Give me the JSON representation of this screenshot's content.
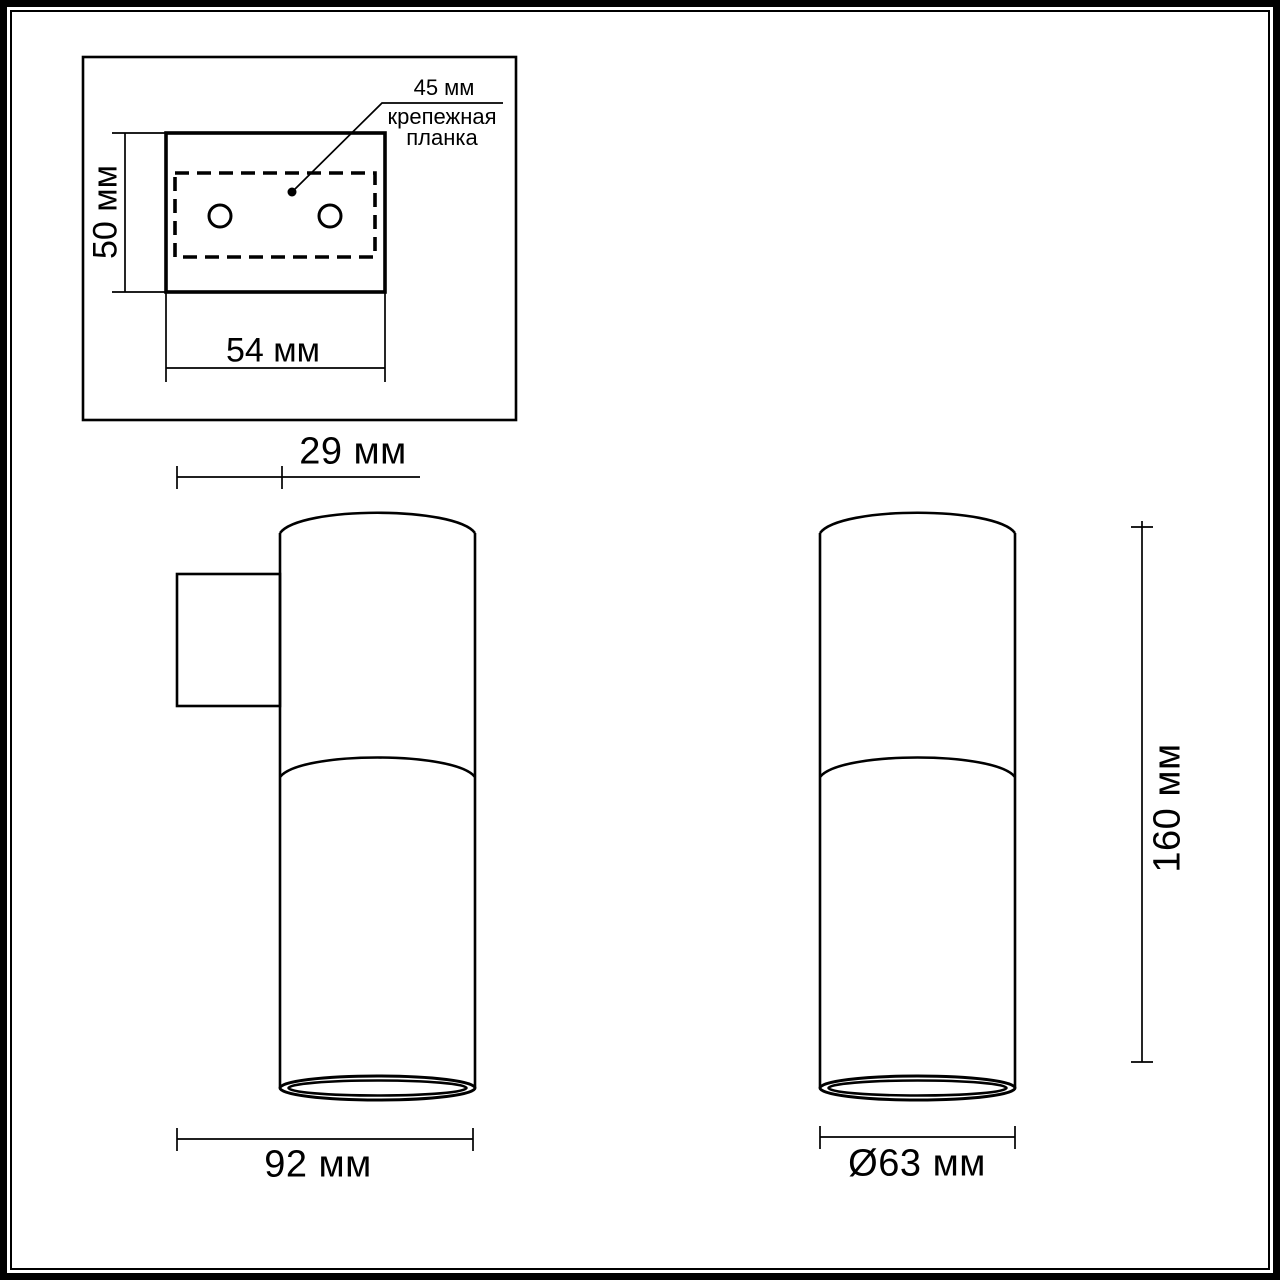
{
  "drawing": {
    "background_color": "#ffffff",
    "line_color": "#000000",
    "views": {
      "mounting_plate_top_view": {
        "plate_height_label": "50 мм",
        "plate_width_label": "54 мм",
        "bracket_length_label": "45 мм",
        "bracket_callout_line1": "крепежная",
        "bracket_callout_line2": "планка"
      },
      "side_view": {
        "bracket_depth_label": "29 мм",
        "total_depth_label": "92 мм"
      },
      "front_view": {
        "height_label": "160 мм",
        "diameter_label": "Ø63 мм"
      }
    },
    "dimensions_mm": {
      "plate_height": 50,
      "plate_width": 54,
      "bracket_length": 45,
      "bracket_depth": 29,
      "total_depth": 92,
      "body_diameter": 63,
      "body_height": 160
    }
  }
}
